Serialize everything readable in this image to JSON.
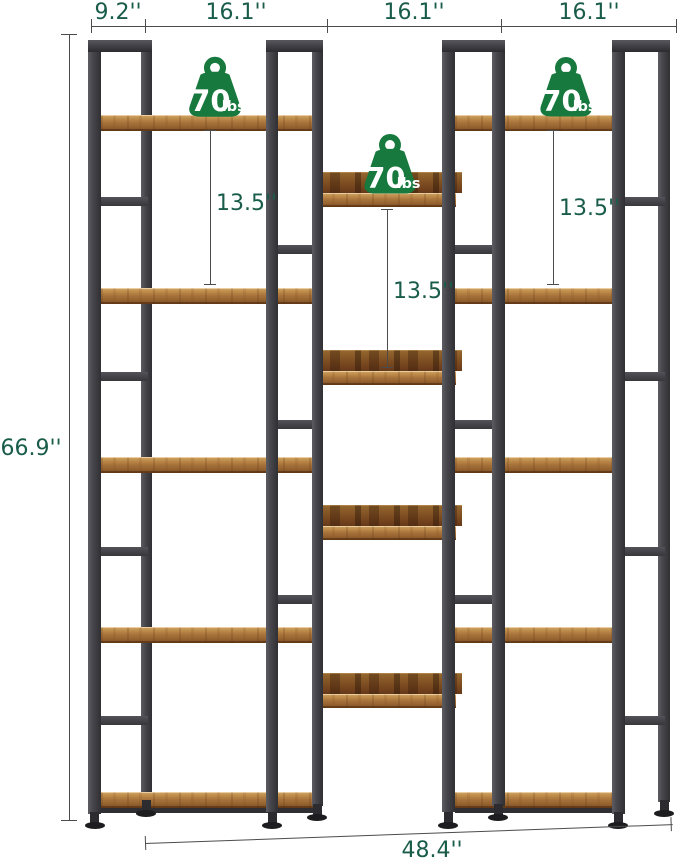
{
  "dimensions": {
    "depth": "9.2''",
    "section_widths": [
      "16.1''",
      "16.1''",
      "16.1''"
    ],
    "height": "66.9''",
    "shelf_spacings": [
      "13.5''",
      "13.5''",
      "13.5''"
    ],
    "total_width": "48.4''"
  },
  "capacity": {
    "number": "70",
    "unit": "lbs"
  },
  "colors": {
    "dimension_text": "#1a5c4a",
    "capacity_icon": "#17793d",
    "frame": "#3f3f44",
    "wood": "#a9753c"
  }
}
